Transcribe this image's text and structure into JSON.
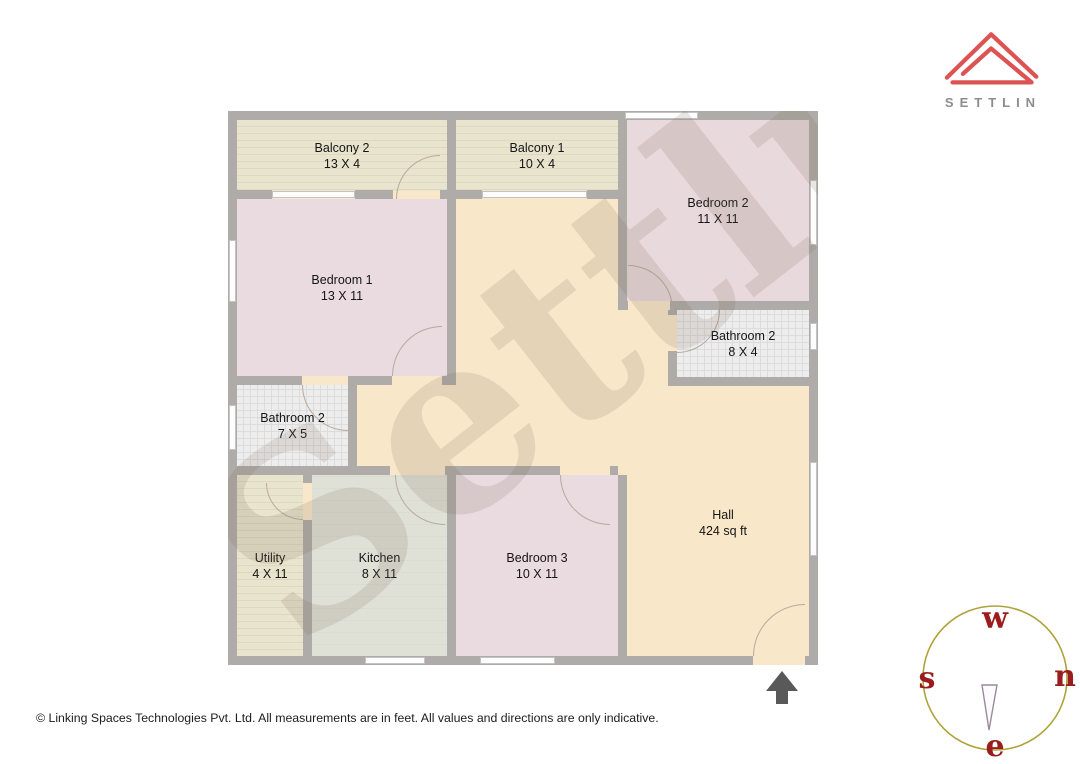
{
  "logo": {
    "brand": "SETTLIN"
  },
  "watermark": {
    "text": "Settlin"
  },
  "rooms": [
    {
      "id": "balcony-2",
      "label": "Balcony 2",
      "dims": "13 X 4"
    },
    {
      "id": "balcony-1",
      "label": "Balcony 1",
      "dims": "10 X 4"
    },
    {
      "id": "bedroom-2",
      "label": "Bedroom 2",
      "dims": "11 X 11"
    },
    {
      "id": "bedroom-1",
      "label": "Bedroom 1",
      "dims": "13 X 11"
    },
    {
      "id": "bathroom-2-right",
      "label": "Bathroom 2",
      "dims": "8 X 4"
    },
    {
      "id": "bathroom-2-left",
      "label": "Bathroom 2",
      "dims": "7 X 5"
    },
    {
      "id": "utility",
      "label": "Utility",
      "dims": "4 X 11"
    },
    {
      "id": "kitchen",
      "label": "Kitchen",
      "dims": "8 X 11"
    },
    {
      "id": "bedroom-3",
      "label": "Bedroom 3",
      "dims": "10 X 11"
    },
    {
      "id": "hall",
      "label": "Hall",
      "dims": "424 sq ft"
    }
  ],
  "compass": {
    "top": "w",
    "left": "s",
    "right": "n",
    "bottom": "e"
  },
  "footer": {
    "copyright": "© Linking Spaces Technologies Pvt. Ltd. All measurements are in feet. All values and directions are only indicative."
  },
  "palette": {
    "wall": "#aeaba8",
    "hall": "#f8e7c9",
    "bedroom": "#e9dbdf",
    "balcony": "#e8e4cd",
    "bathroom": "#ededed",
    "kitchen": "#dfe1d7",
    "logo_red": "#dd5353",
    "brand_gray": "#8d8d8d",
    "compass_circle": "#b0a23a",
    "compass_letters": "#9b1c1c",
    "entrance_arrow": "#595959"
  }
}
